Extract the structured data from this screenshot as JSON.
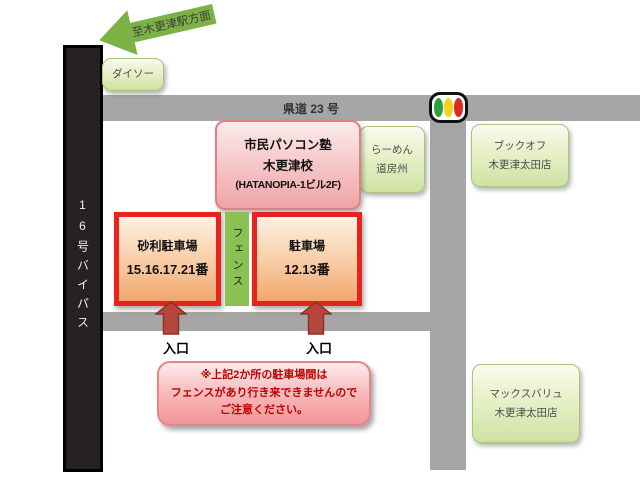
{
  "top_arrow": {
    "label": "至木更津駅方面"
  },
  "roads": {
    "bypass": "16号バイパス",
    "kendo": "県道 23 号"
  },
  "traffic_light_icon": "traffic-signal",
  "landmarks": {
    "daiso": "ダイソー",
    "ramen_line1": "らーめん",
    "ramen_line2": "道房州",
    "bookoff_line1": "ブックオフ",
    "bookoff_line2": "木更津太田店",
    "maxvalu_line1": "マックスバリュ",
    "maxvalu_line2": "木更津太田店"
  },
  "school": {
    "line1": "市民パソコン塾",
    "line2": "木更津校",
    "line3": "(HATANOPIA-1ビル2F)"
  },
  "parking": {
    "lot1_line1": "砂利駐車場",
    "lot1_line2": "15.16.17.21番",
    "fence": "フェンス",
    "lot2_line1": "駐車場",
    "lot2_line2": "12.13番",
    "entrance1": "入口",
    "entrance2": "入口"
  },
  "notice": {
    "line1": "※上記2か所の駐車場間は",
    "line2": "フェンスがあり行き来できませんので",
    "line3": "ご注意ください。"
  },
  "palette": {
    "road_gray": "#a6a6a6",
    "bypass_black": "#262222",
    "arrow_green": "#7cb245",
    "fence_green": "#8bc152",
    "landmark_green": "#cfe2a2",
    "school_pink_border": "#de8184",
    "parking_red_border": "#e8231d",
    "entrance_arrow_red": "#b5463c",
    "notice_text_red": "#c00000",
    "signal_green": "#2e9f3c",
    "signal_yellow": "#f2d41d",
    "signal_red": "#dc2a20"
  }
}
